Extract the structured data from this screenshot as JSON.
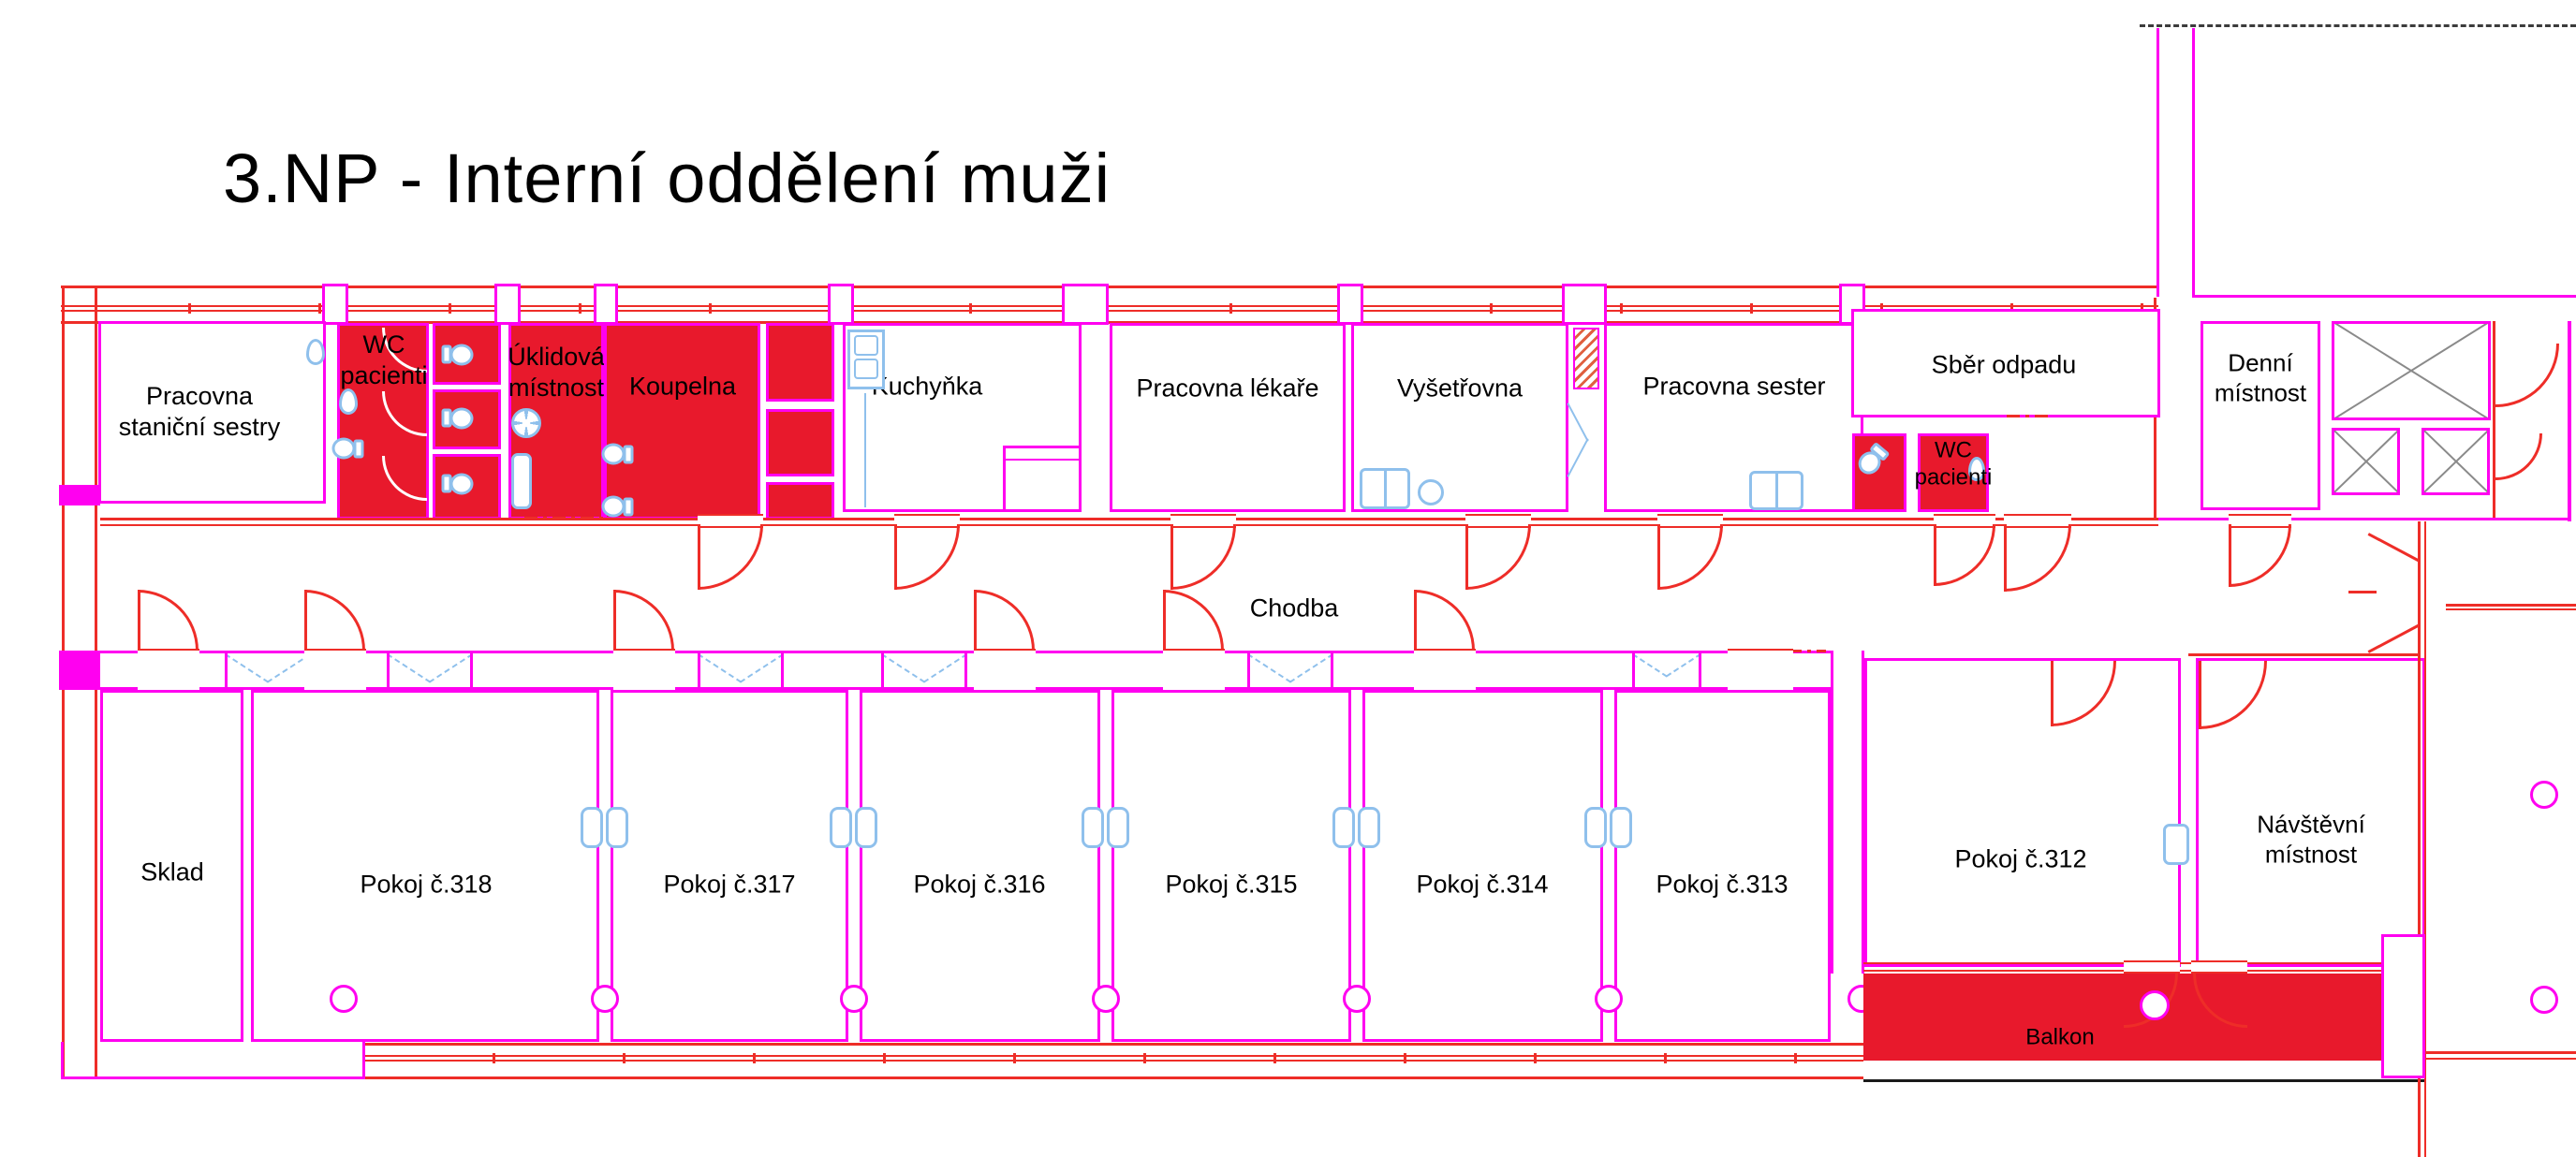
{
  "title": "3.NP - Interní oddělení muži",
  "colors": {
    "wall_magenta": "#ff00f0",
    "line_red": "#ee2d28",
    "room_fill_red": "#e8192c",
    "fixture_blue": "#8fc0ec",
    "shaft_gray": "#8a8a8a"
  },
  "rooms": {
    "pracovna_stanicni_sestry": {
      "label": "Pracovna staniční sestry"
    },
    "wc_pacienti_west": {
      "label": "WC pacienti"
    },
    "uklidova_mistnost": {
      "label": "Úklidová místnost"
    },
    "koupelna": {
      "label": "Koupelna"
    },
    "kuchynka": {
      "label": "Kuchyňka"
    },
    "pracovna_lekare": {
      "label": "Pracovna lékaře"
    },
    "vysetrovna": {
      "label": "Vyšetřovna"
    },
    "pracovna_sester": {
      "label": "Pracovna sester"
    },
    "sber_odpadu": {
      "label": "Sběr odpadu"
    },
    "wc_pacienti_east": {
      "label": "WC pacienti"
    },
    "denni_mistnost": {
      "label": "Denní místnost"
    },
    "chodba": {
      "label": "Chodba"
    },
    "sklad": {
      "label": "Sklad"
    },
    "pokoj_318": {
      "label": "Pokoj č.318"
    },
    "pokoj_317": {
      "label": "Pokoj č.317"
    },
    "pokoj_316": {
      "label": "Pokoj č.316"
    },
    "pokoj_315": {
      "label": "Pokoj č.315"
    },
    "pokoj_314": {
      "label": "Pokoj č.314"
    },
    "pokoj_313": {
      "label": "Pokoj č.313"
    },
    "pokoj_312": {
      "label": "Pokoj č.312"
    },
    "navstevni_mistnost": {
      "label": "Návštěvní místnost"
    },
    "balkon": {
      "label": "Balkon"
    }
  }
}
